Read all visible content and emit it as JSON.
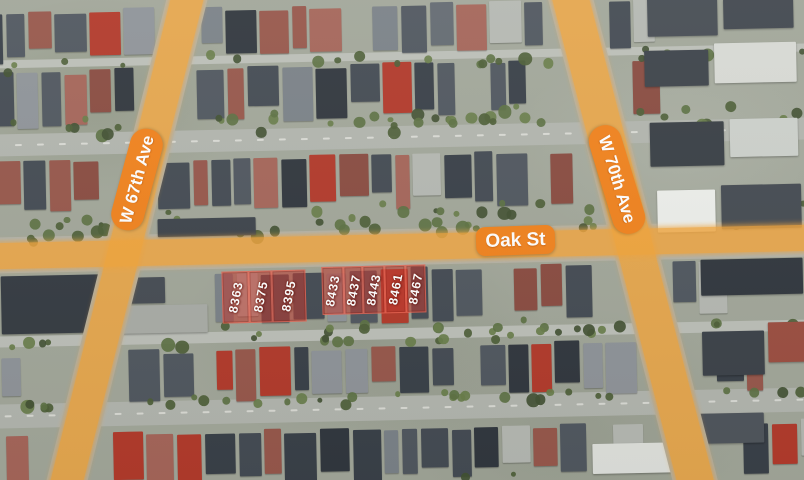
{
  "streets": {
    "w67": {
      "label": "W 67th Ave"
    },
    "w70": {
      "label": "W 70th Ave"
    },
    "oak": {
      "label": "Oak St"
    }
  },
  "lots": {
    "numbers": [
      "8363",
      "8375",
      "8395",
      "8433",
      "8437",
      "8443",
      "8461",
      "8467"
    ]
  },
  "colors": {
    "street_highlight": "#F2A53C",
    "street_badge": "#F0831F",
    "lot_highlight_fill": "rgba(195,57,45,0.55)",
    "lot_highlight_border": "rgba(255,122,100,0.55)",
    "label_text": "#FFFFFF"
  }
}
